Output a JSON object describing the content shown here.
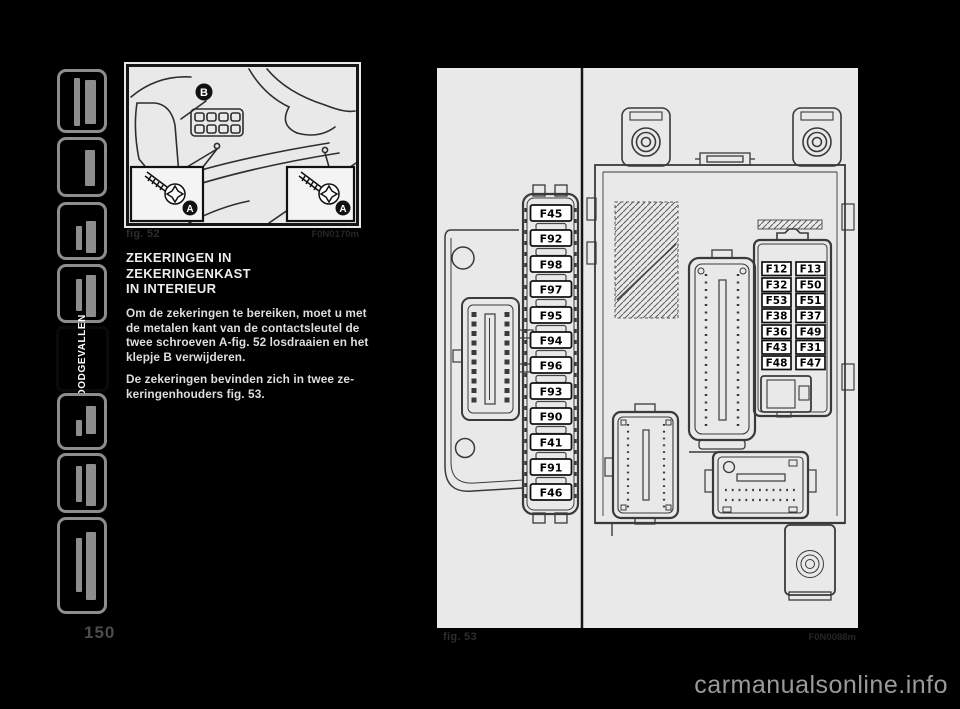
{
  "page": {
    "number": "150",
    "watermark": "carmanualsonline.info"
  },
  "sidebar": {
    "active_label": "NOODGEVALLEN"
  },
  "article": {
    "heading_lines": [
      "ZEKERINGEN IN",
      "ZEKERINGENKAST",
      "IN INTERIEUR"
    ],
    "para1_lines": [
      "Om de zekeringen te bereiken, moet u met",
      "de metalen kant van de contactsleutel de",
      "twee schroeven A-fig. 52 losdraaien en het",
      "klepje B verwijderen."
    ],
    "para2_lines": [
      "De zekeringen bevinden zich in twee ze-",
      "keringenhouders fig. 53."
    ]
  },
  "fig52": {
    "caption": "fig. 52",
    "code": "F0N0170m",
    "labels": {
      "b": "B",
      "a_left": "A",
      "a_right": "A"
    }
  },
  "fig53": {
    "caption": "fig. 53",
    "code": "F0N0088m",
    "left_fuses": [
      "F45",
      "F92",
      "F98",
      "F97",
      "F95",
      "F94",
      "F96",
      "F93",
      "F90",
      "F41",
      "F91",
      "F46"
    ],
    "grid_rows": [
      [
        "F12",
        "F13"
      ],
      [
        "F32",
        "F50"
      ],
      [
        "F53",
        "F51"
      ],
      [
        "F38",
        "F37"
      ],
      [
        "F36",
        "F49"
      ],
      [
        "F43",
        "F31"
      ],
      [
        "F48",
        "F47"
      ]
    ]
  }
}
